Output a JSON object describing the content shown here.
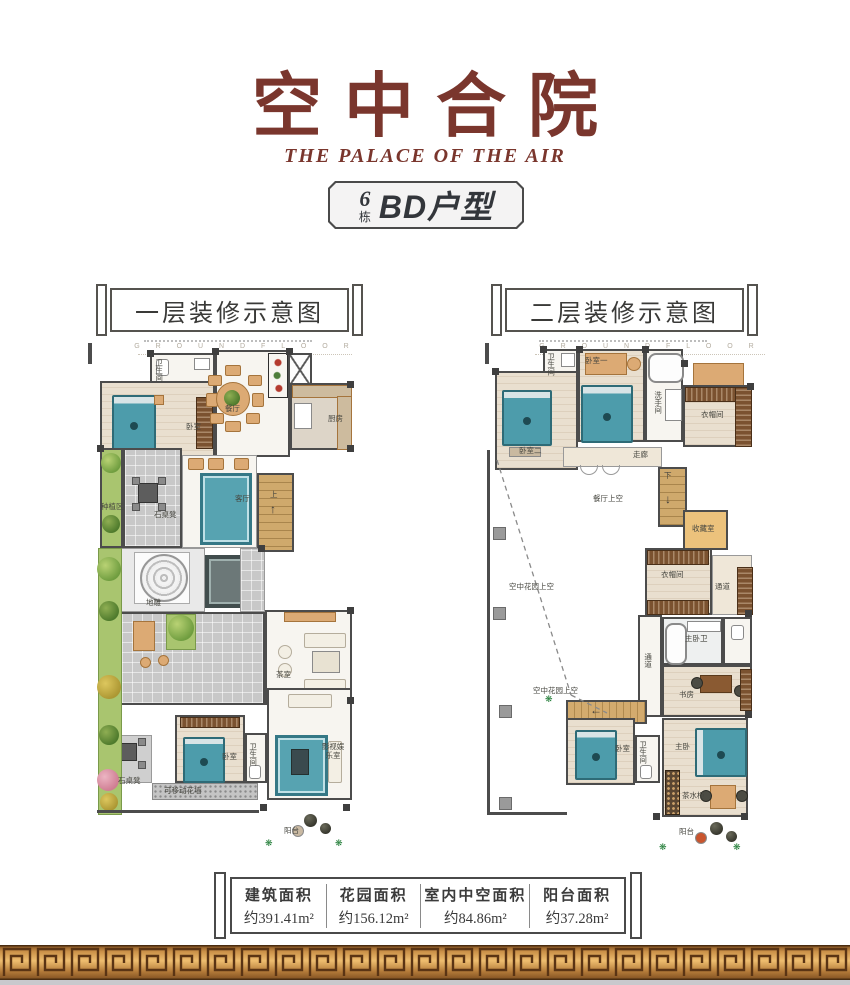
{
  "header": {
    "title": "空中合院",
    "subtitle": "THE PALACE OF THE AIR",
    "badge": {
      "number": "6",
      "number_unit": "栋",
      "unit_type": "BD户型"
    }
  },
  "floor1": {
    "panel_label": "一层装修示意图",
    "watermark": "G R O U N D   F L O O R",
    "room_labels": [
      {
        "text": "卫生间",
        "x": 66,
        "y": 14,
        "v": true
      },
      {
        "text": "卧室",
        "x": 98,
        "y": 78
      },
      {
        "text": "餐厅",
        "x": 137,
        "y": 60
      },
      {
        "text": "厨房",
        "x": 240,
        "y": 70
      },
      {
        "text": "种植区",
        "x": 13,
        "y": 158
      },
      {
        "text": "石桌凳",
        "x": 66,
        "y": 166
      },
      {
        "text": "客厅",
        "x": 147,
        "y": 150
      },
      {
        "text": "上",
        "x": 182,
        "y": 146
      },
      {
        "text": "地雕",
        "x": 58,
        "y": 254
      },
      {
        "text": "茶室",
        "x": 188,
        "y": 326
      },
      {
        "text": "卧室",
        "x": 134,
        "y": 408
      },
      {
        "text": "卫生间",
        "x": 160,
        "y": 398,
        "v": true
      },
      {
        "text": "影视娱乐室",
        "x": 232,
        "y": 398,
        "wrap": true
      },
      {
        "text": "石桌凳",
        "x": 30,
        "y": 432
      },
      {
        "text": "可移动花墙",
        "x": 76,
        "y": 442
      },
      {
        "text": "阳台",
        "x": 196,
        "y": 482
      }
    ]
  },
  "floor2": {
    "panel_label": "二层装修示意图",
    "watermark": "G R O U N D   F L O O R",
    "room_labels": [
      {
        "text": "卫生间",
        "x": 61,
        "y": 8,
        "v": true
      },
      {
        "text": "卧室一",
        "x": 100,
        "y": 12
      },
      {
        "text": "洗手间",
        "x": 168,
        "y": 46,
        "v": true
      },
      {
        "text": "衣帽间",
        "x": 216,
        "y": 66
      },
      {
        "text": "卧室二",
        "x": 34,
        "y": 102
      },
      {
        "text": "走廊",
        "x": 148,
        "y": 106
      },
      {
        "text": "下",
        "x": 179,
        "y": 127
      },
      {
        "text": "餐厅上空",
        "x": 108,
        "y": 150
      },
      {
        "text": "收藏室",
        "x": 207,
        "y": 180
      },
      {
        "text": "衣帽间",
        "x": 176,
        "y": 226
      },
      {
        "text": "通道",
        "x": 230,
        "y": 238
      },
      {
        "text": "主卧卫",
        "x": 200,
        "y": 290
      },
      {
        "text": "通道",
        "x": 158,
        "y": 308,
        "v": true
      },
      {
        "text": "书房",
        "x": 194,
        "y": 346
      },
      {
        "text": "空中花园上空",
        "x": 24,
        "y": 238
      },
      {
        "text": "空中花园上空",
        "x": 48,
        "y": 342
      },
      {
        "text": "卧室",
        "x": 130,
        "y": 400
      },
      {
        "text": "卫生间",
        "x": 153,
        "y": 396,
        "v": true
      },
      {
        "text": "主卧",
        "x": 190,
        "y": 398
      },
      {
        "text": "茶水柜",
        "x": 197,
        "y": 447
      },
      {
        "text": "阳台",
        "x": 194,
        "y": 483
      }
    ]
  },
  "area_info": {
    "items": [
      {
        "label": "建筑面积",
        "value": "约391.41m²"
      },
      {
        "label": "花园面积",
        "value": "约156.12m²"
      },
      {
        "label": "室内中空面积",
        "value": "约84.86m²"
      },
      {
        "label": "阳台面积",
        "value": "约37.28m²"
      }
    ]
  },
  "colors": {
    "accent_maroon": "#7a362d",
    "wall": "#4c4c4c",
    "teal_bed": "#4d9cab",
    "tan_furniture": "#dcaa74",
    "plant_green": "#a9c56f",
    "gold_border": "#c98f47"
  }
}
